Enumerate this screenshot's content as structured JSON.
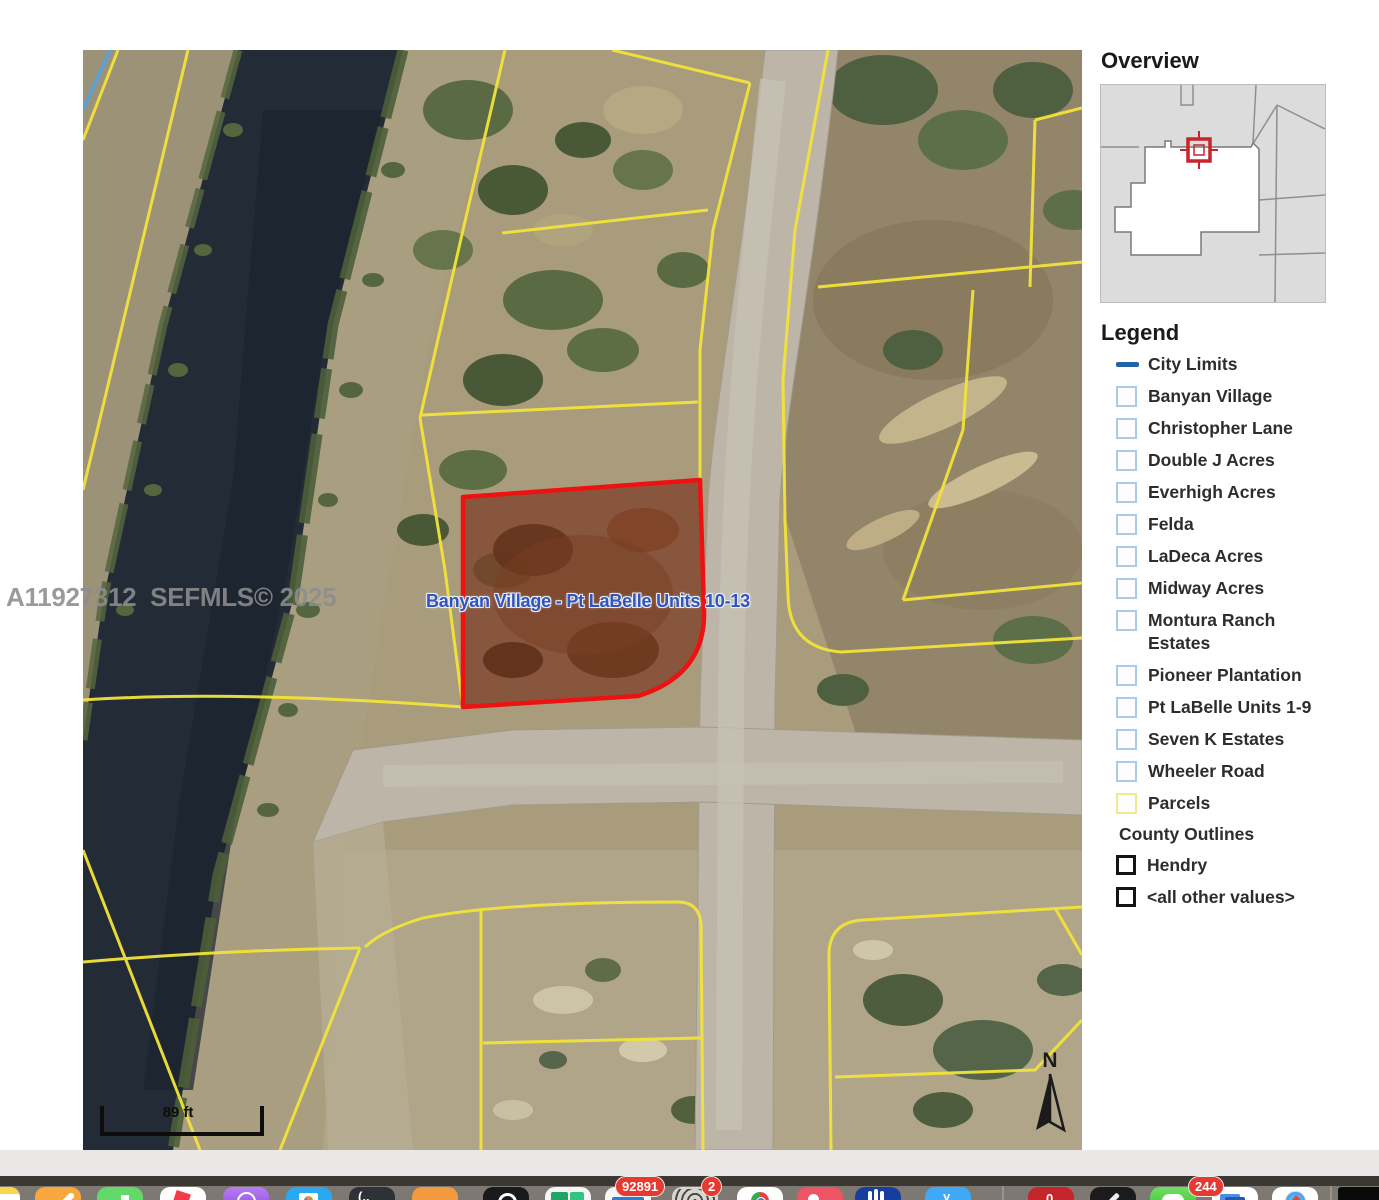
{
  "map": {
    "watermark": "A11927312  SEFMLS© 2025",
    "selected_parcel_label": "Banyan Village - Pt LaBelle Units 10-13",
    "scale_text": "89 ft",
    "north_label": "N",
    "colors": {
      "parcel_line": "#f2e33a",
      "selected_parcel_outline": "#ee1111",
      "parcel_label_blue": "#3353bd",
      "water": "#232b36",
      "city_limits_blue": "#5aa0d8"
    }
  },
  "overview": {
    "title": "Overview"
  },
  "legend": {
    "title": "Legend",
    "items": [
      {
        "label": "City Limits",
        "swatch": "line"
      },
      {
        "label": "Banyan Village",
        "swatch": "blue-box"
      },
      {
        "label": "Christopher Lane",
        "swatch": "blue-box"
      },
      {
        "label": "Double J Acres",
        "swatch": "blue-box"
      },
      {
        "label": "Everhigh Acres",
        "swatch": "blue-box"
      },
      {
        "label": "Felda",
        "swatch": "blue-box"
      },
      {
        "label": "LaDeca Acres",
        "swatch": "blue-box"
      },
      {
        "label": "Midway Acres",
        "swatch": "blue-box"
      },
      {
        "label": "Montura Ranch Estates",
        "swatch": "blue-box"
      },
      {
        "label": "Pioneer Plantation",
        "swatch": "blue-box"
      },
      {
        "label": "Pt LaBelle Units 1-9",
        "swatch": "blue-box"
      },
      {
        "label": "Seven K Estates",
        "swatch": "blue-box"
      },
      {
        "label": "Wheeler Road",
        "swatch": "blue-box"
      },
      {
        "label": "Parcels",
        "swatch": "yellow-box"
      }
    ],
    "subheading": "County Outlines",
    "county_items": [
      {
        "label": "Hendry"
      },
      {
        "label": "<all other values>"
      }
    ],
    "colors": {
      "city_limits_line": "#2463a8",
      "blue_box": "#a9cbe8",
      "yellow_box": "#ecec8c",
      "county_box": "#141414"
    }
  },
  "dock": {
    "icons": [
      "notes",
      "pages",
      "numbers",
      "news",
      "podcasts",
      "photo-booth",
      "terminal",
      "orange-app",
      "camera-app",
      "excel",
      "outlook",
      "spiral-app",
      "chrome",
      "music",
      "hand-app",
      "y-app",
      "red-app",
      "pen-app",
      "messages",
      "word",
      "safari",
      "minimized-window"
    ],
    "badges": {
      "outlook": "92891",
      "spiral_app": "2",
      "messages": "244"
    }
  }
}
